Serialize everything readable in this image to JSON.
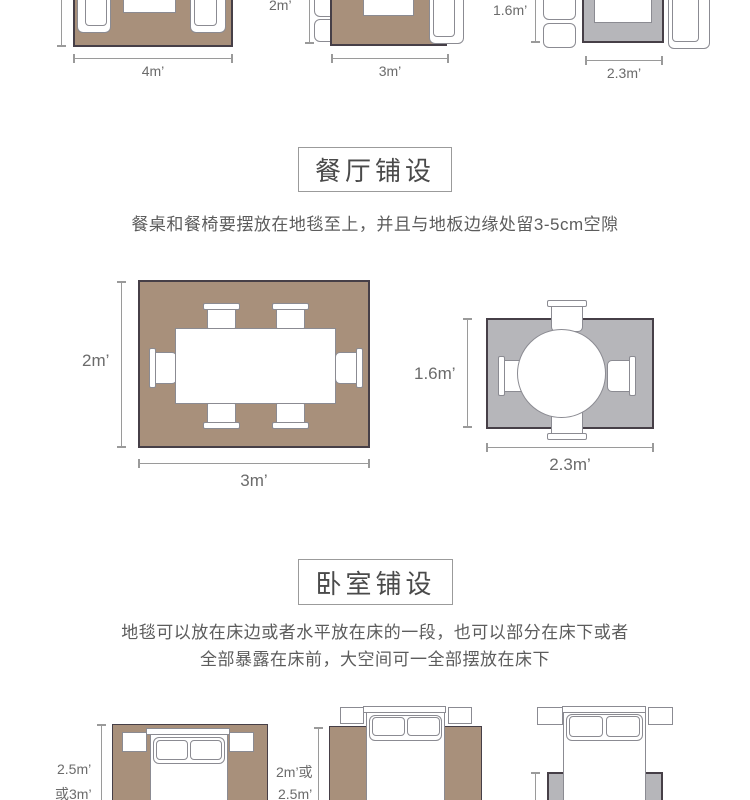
{
  "colors": {
    "rug_brown": "#a8907b",
    "rug_gray": "#b6b6ba",
    "rug_border": "#463f47",
    "furniture_border": "#8b8b92",
    "dim_color": "#9a9a9a",
    "label_color": "#6b6b6b",
    "title_color": "#4a4a4a",
    "box_border": "#9b9b9b"
  },
  "top_row": {
    "living_4m": {
      "width_label": "4m’"
    },
    "living_3m": {
      "height_label": "2m’",
      "width_label": "3m’"
    },
    "living_2_3m": {
      "height_label": "1.6m’",
      "width_label": "2.3m’"
    }
  },
  "dining": {
    "title": "餐厅铺设",
    "description": "餐桌和餐椅要摆放在地毯至上，并且与地板边缘处留3-5cm空隙",
    "rect_table": {
      "height_label": "2m’",
      "width_label": "3m’"
    },
    "round_table": {
      "height_label": "1.6m’",
      "width_label": "2.3m’"
    }
  },
  "bedroom": {
    "title": "卧室铺设",
    "description_line1": "地毯可以放在床边或者水平放在床的一段，也可以部分在床下或者",
    "description_line2": "全部暴露在床前，大空间可一全部摆放在床下",
    "bed_full": {
      "height_label_line1": "2.5m’",
      "height_label_line2": "或3m’"
    },
    "bed_half": {
      "height_label_line1": "2m’或",
      "height_label_line2": "2.5m’"
    }
  }
}
